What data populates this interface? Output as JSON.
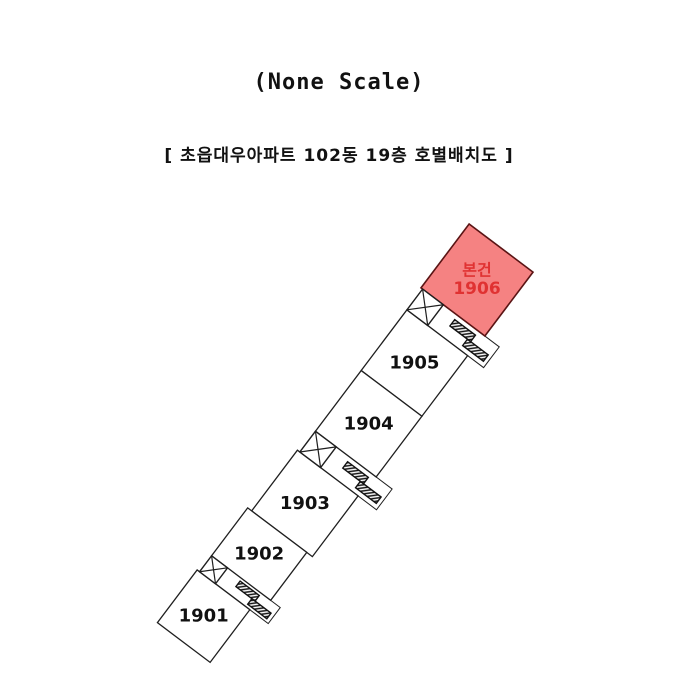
{
  "page": {
    "background": "#ffffff"
  },
  "header": {
    "title": "(None Scale)",
    "subtitle": "[  초읍대우아파트 102동 19층 호별배치도  ]"
  },
  "floorplan": {
    "rotation_deg": 37,
    "origin": {
      "x": 477,
      "y": 280
    },
    "line_color": "#1f1f1f",
    "unit_fill": "#ffffff",
    "label_color": "#111111",
    "label_font_size": 18,
    "highlight_font_size": 16,
    "highlight": {
      "fill": "#f58282",
      "stroke": "#5a1414",
      "text_color": "#e03232"
    },
    "units": [
      {
        "id": "1906",
        "label": "1906",
        "sublabel": "본건",
        "cx": 0,
        "cy": 0,
        "w": 80,
        "h": 80,
        "highlighted": true
      },
      {
        "id": "1905",
        "label": "1905",
        "cx": 0,
        "cy": 104,
        "w": 76,
        "h": 76,
        "highlighted": false
      },
      {
        "id": "1904",
        "label": "1904",
        "cx": 0,
        "cy": 180,
        "w": 76,
        "h": 76,
        "highlighted": false
      },
      {
        "id": "1903",
        "label": "1903",
        "cx": -3,
        "cy": 282,
        "w": 76,
        "h": 76,
        "highlighted": false
      },
      {
        "id": "1902",
        "label": "1902",
        "cx": -9,
        "cy": 350,
        "w": 74,
        "h": 60,
        "highlighted": false
      },
      {
        "id": "1901",
        "label": "1901",
        "cx": -16,
        "cy": 433,
        "w": 66,
        "h": 66,
        "highlighted": false
      }
    ],
    "cores": [
      {
        "name": "core-1905-1906",
        "outline": {
          "x": -38,
          "y": 40,
          "w": 96,
          "h": 26
        },
        "stair": {
          "x": -38,
          "y": 40,
          "w": 26,
          "h": 26
        },
        "lifts": [
          {
            "x": 6,
            "y": 45,
            "w": 26,
            "h": 8
          },
          {
            "x": 28,
            "y": 53,
            "w": 26,
            "h": 8
          }
        ]
      },
      {
        "name": "core-1903-1904",
        "outline": {
          "x": -38,
          "y": 218,
          "w": 96,
          "h": 26
        },
        "stair": {
          "x": -38,
          "y": 218,
          "w": 26,
          "h": 26
        },
        "lifts": [
          {
            "x": 6,
            "y": 223,
            "w": 26,
            "h": 8
          },
          {
            "x": 28,
            "y": 231,
            "w": 26,
            "h": 8
          }
        ]
      },
      {
        "name": "core-1901-1902",
        "outline": {
          "x": -46,
          "y": 380,
          "w": 86,
          "h": 20
        },
        "stair": {
          "x": -46,
          "y": 380,
          "w": 20,
          "h": 20
        },
        "lifts": [
          {
            "x": -8,
            "y": 383,
            "w": 24,
            "h": 7
          },
          {
            "x": 12,
            "y": 390,
            "w": 24,
            "h": 7
          }
        ]
      }
    ]
  }
}
